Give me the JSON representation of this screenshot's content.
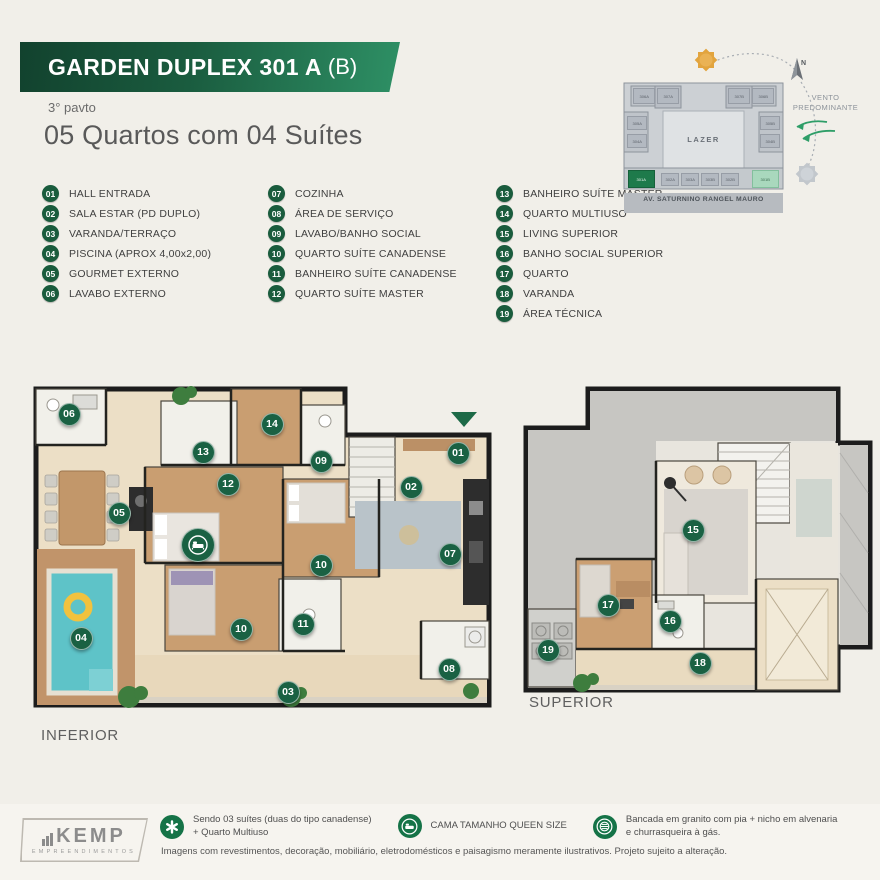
{
  "header": {
    "title_main": "GARDEN DUPLEX 301 A",
    "title_suffix": "(B)",
    "floor_note": "3° pavto",
    "subtitle": "05 Quartos com 04 Suítes"
  },
  "legend": {
    "columns": [
      [
        {
          "num": "01",
          "label": "HALL ENTRADA"
        },
        {
          "num": "02",
          "label": "SALA ESTAR (PD DUPLO)"
        },
        {
          "num": "03",
          "label": "VARANDA/TERRAÇO"
        },
        {
          "num": "04",
          "label": "PISCINA (APROX 4,00x2,00)"
        },
        {
          "num": "05",
          "label": "GOURMET EXTERNO"
        },
        {
          "num": "06",
          "label": "LAVABO EXTERNO"
        }
      ],
      [
        {
          "num": "07",
          "label": "COZINHA"
        },
        {
          "num": "08",
          "label": "ÁREA DE SERVIÇO"
        },
        {
          "num": "09",
          "label": "LAVABO/BANHO SOCIAL"
        },
        {
          "num": "10",
          "label": "QUARTO SUÍTE CANADENSE"
        },
        {
          "num": "11",
          "label": "BANHEIRO SUÍTE CANADENSE"
        },
        {
          "num": "12",
          "label": "QUARTO SUÍTE MASTER"
        }
      ],
      [
        {
          "num": "13",
          "label": "BANHEIRO SUÍTE MASTER"
        },
        {
          "num": "14",
          "label": "QUARTO MULTIUSO"
        },
        {
          "num": "15",
          "label": "LIVING SUPERIOR"
        },
        {
          "num": "16",
          "label": "BANHO SOCIAL SUPERIOR"
        },
        {
          "num": "17",
          "label": "QUARTO"
        },
        {
          "num": "18",
          "label": "VARANDA"
        },
        {
          "num": "19",
          "label": "ÁREA TÉCNICA"
        }
      ]
    ]
  },
  "site_plan": {
    "lazer": "LAZER",
    "street": "AV. SATURNINO RANGEL MAURO",
    "north": "N",
    "wind_line1": "VENTO",
    "wind_line2": "PREDOMINANTE",
    "units": [
      {
        "label": "306A",
        "x": 28,
        "y": 50,
        "w": 22,
        "h": 16,
        "variant": "plain"
      },
      {
        "label": "307A",
        "x": 52,
        "y": 50,
        "w": 22,
        "h": 16,
        "variant": "plain"
      },
      {
        "label": "307B",
        "x": 123,
        "y": 50,
        "w": 22,
        "h": 16,
        "variant": "plain"
      },
      {
        "label": "306B",
        "x": 147,
        "y": 50,
        "w": 22,
        "h": 16,
        "variant": "plain"
      },
      {
        "label": "305A",
        "x": 22,
        "y": 78,
        "w": 20,
        "h": 14,
        "variant": "plain"
      },
      {
        "label": "304A",
        "x": 22,
        "y": 96,
        "w": 20,
        "h": 14,
        "variant": "plain"
      },
      {
        "label": "305B",
        "x": 155,
        "y": 78,
        "w": 20,
        "h": 14,
        "variant": "plain"
      },
      {
        "label": "304B",
        "x": 155,
        "y": 96,
        "w": 20,
        "h": 14,
        "variant": "plain"
      },
      {
        "label": "301A",
        "x": 23,
        "y": 132,
        "w": 27,
        "h": 18,
        "variant": "dark"
      },
      {
        "label": "302A",
        "x": 56,
        "y": 135,
        "w": 18,
        "h": 13,
        "variant": "plain"
      },
      {
        "label": "303A",
        "x": 76,
        "y": 135,
        "w": 18,
        "h": 13,
        "variant": "plain"
      },
      {
        "label": "303B",
        "x": 96,
        "y": 135,
        "w": 18,
        "h": 13,
        "variant": "plain"
      },
      {
        "label": "302B",
        "x": 116,
        "y": 135,
        "w": 18,
        "h": 13,
        "variant": "plain"
      },
      {
        "label": "301B",
        "x": 147,
        "y": 132,
        "w": 27,
        "h": 18,
        "variant": "light"
      }
    ]
  },
  "plans": {
    "inferior": {
      "label": "INFERIOR",
      "badges": [
        {
          "n": "06",
          "x": 36,
          "y": 31
        },
        {
          "n": "14",
          "x": 239,
          "y": 41
        },
        {
          "n": "13",
          "x": 170,
          "y": 69
        },
        {
          "n": "01",
          "x": 425,
          "y": 70
        },
        {
          "n": "09",
          "x": 288,
          "y": 78
        },
        {
          "n": "12",
          "x": 195,
          "y": 101
        },
        {
          "n": "02",
          "x": 378,
          "y": 104
        },
        {
          "n": "05",
          "x": 86,
          "y": 130
        },
        {
          "type": "bed",
          "x": 165,
          "y": 162
        },
        {
          "n": "07",
          "x": 417,
          "y": 171
        },
        {
          "n": "10",
          "x": 288,
          "y": 182
        },
        {
          "n": "11",
          "x": 270,
          "y": 241
        },
        {
          "n": "10",
          "x": 208,
          "y": 246
        },
        {
          "n": "04",
          "x": 48,
          "y": 255
        },
        {
          "n": "08",
          "x": 416,
          "y": 286
        },
        {
          "n": "03",
          "x": 255,
          "y": 309
        }
      ]
    },
    "superior": {
      "label": "SUPERIOR",
      "badges": [
        {
          "n": "15",
          "x": 175,
          "y": 147
        },
        {
          "n": "17",
          "x": 90,
          "y": 222
        },
        {
          "n": "16",
          "x": 152,
          "y": 238
        },
        {
          "n": "19",
          "x": 30,
          "y": 267
        },
        {
          "n": "18",
          "x": 182,
          "y": 280
        }
      ]
    }
  },
  "footer": {
    "logo_name": "KEMP",
    "logo_subtitle": "EMPREENDIMENTOS",
    "notes": [
      {
        "icon": "asterisk-icon",
        "line1": "Sendo 03 suítes (duas do tipo canadense)",
        "line2": "+ Quarto Multiuso"
      },
      {
        "icon": "bed-icon",
        "line1": "CAMA TAMANHO QUEEN SIZE",
        "line2": ""
      },
      {
        "icon": "grill-icon",
        "line1": "Bancada em granito com pia + nicho em alvenaria",
        "line2": "e churrasqueira à gás."
      }
    ],
    "disclaimer": "Imagens com revestimentos, decoração, mobiliário, eletrodomésticos e paisagismo meramente ilustrativos. Projeto sujeito a alteração."
  },
  "colors": {
    "brand_dark": "#12422e",
    "brand": "#1a6143",
    "brand_light": "#2e9065",
    "highlight_light_green": "#a9d8bd",
    "pool_teal": "#5ec3c8",
    "sun_orange": "#e2a43e",
    "float_yellow": "#f2c23e"
  }
}
